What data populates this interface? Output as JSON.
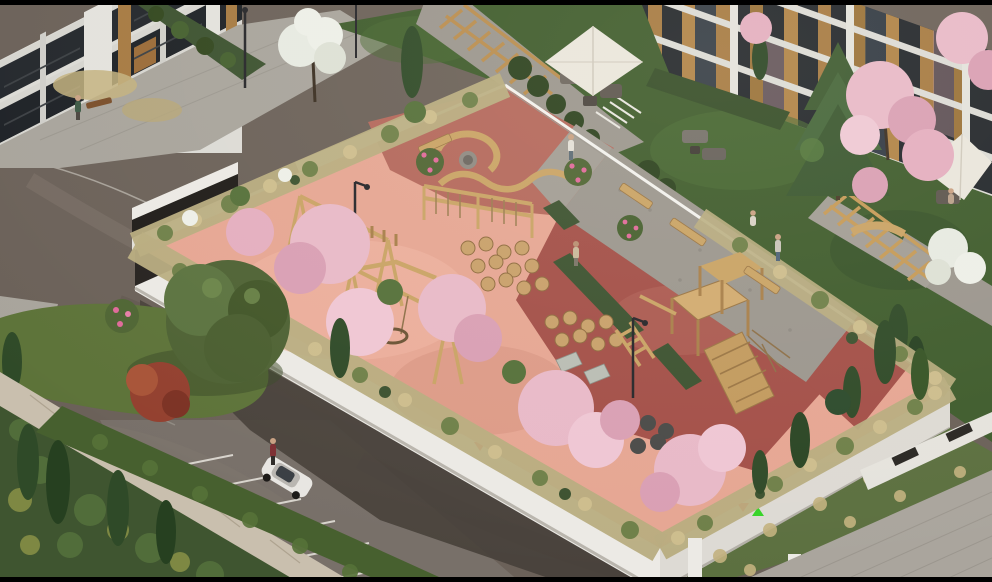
{
  "scene": {
    "title": "Aerial 3D architectural render: residential courtyard with rooftop playground built over an open parking deck",
    "setting": "spring afternoon, warm sunlight from upper right, cherry trees in bloom",
    "elements": [
      "apartment building with green entrance portal (top left)",
      "apartment building with wood-slat balconies (top right)",
      "courtyard garden with pergola walkway and patio umbrellas",
      "rooftop playground with salmon and terracotta rubber surfacing",
      "wooden swing sets, climbing frames and play tower",
      "curved and wavy wooden benches",
      "stepping-stump trails",
      "extensive green roof border planting with cherry blossoms and cypresses",
      "open-sided parking deck with white columns and parked cars",
      "surface parking stalls with white markings and a white hatchback",
      "stone boundary wall topped with trimmed hedge",
      "asphalt access roads and paver footpaths"
    ]
  },
  "objects": {
    "umbrellas": 2,
    "pergolas": 2,
    "visible_cars": 4,
    "people_visible": 7,
    "ventilation_marker_pairs": 3,
    "swing_sets": 2,
    "play_towers": 1,
    "curved_benches": 2
  },
  "palette": {
    "frame": "#000000",
    "asphalt": "#6b6159",
    "asphalt_light": "#7d736a",
    "under_deck": "#47403a",
    "paving_light": "#a8a49c",
    "gravel_path": "#9b968e",
    "lawn": "#5d7339",
    "courtyard_lawn": "#3f5c2d",
    "hedge_dark": "#3c5230",
    "grass_roof": "#b9ad80",
    "stone_wall": "#c9bfae",
    "deck_white": "#eceae5",
    "playground_salmon": "#e6a693",
    "playground_red": "#a34f48",
    "playground_dusty": "#b4685c",
    "wood": "#c9a365",
    "wood_dark": "#9a7544",
    "blossom_pink": "#e8b9c8",
    "blossom_deep": "#d99fb4",
    "blossom_white": "#edefe8",
    "tree_green": "#4e6234",
    "cypress": "#2f4a28",
    "pine": "#3d5a31",
    "building_white": "#dcdbd6",
    "window_dark": "#23272c",
    "wood_facade": "#a67a42",
    "entrance_green": "#3fae3e",
    "umbrella": "#eae6dd",
    "marker_red": "#e8211c",
    "marker_green": "#35d428",
    "car_white": "#e8e6e2",
    "car_brown": "#4a372f"
  }
}
